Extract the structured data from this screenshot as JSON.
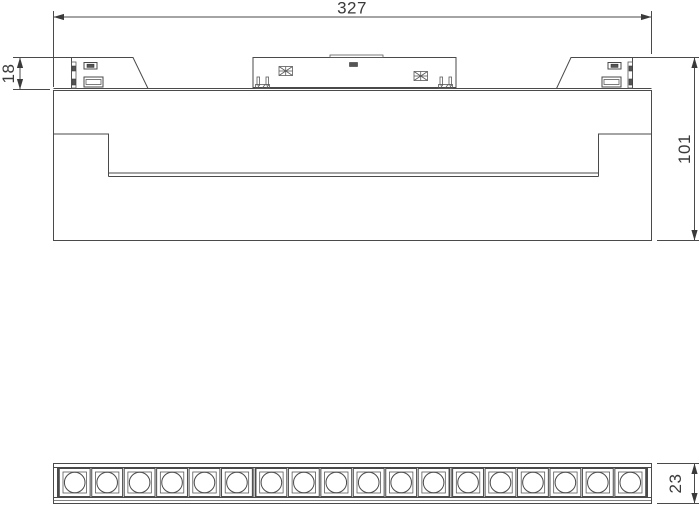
{
  "drawing": {
    "dimensions": {
      "overall_length": "327",
      "clip_height": "18",
      "total_height": "101",
      "bar_height": "23"
    },
    "led_matrix": {
      "modules": 3,
      "cells_per_module": 6,
      "total_cells": 18
    },
    "colors": {
      "line": "#4a4a4a",
      "text": "#3a3a3a",
      "background": "#ffffff"
    }
  }
}
